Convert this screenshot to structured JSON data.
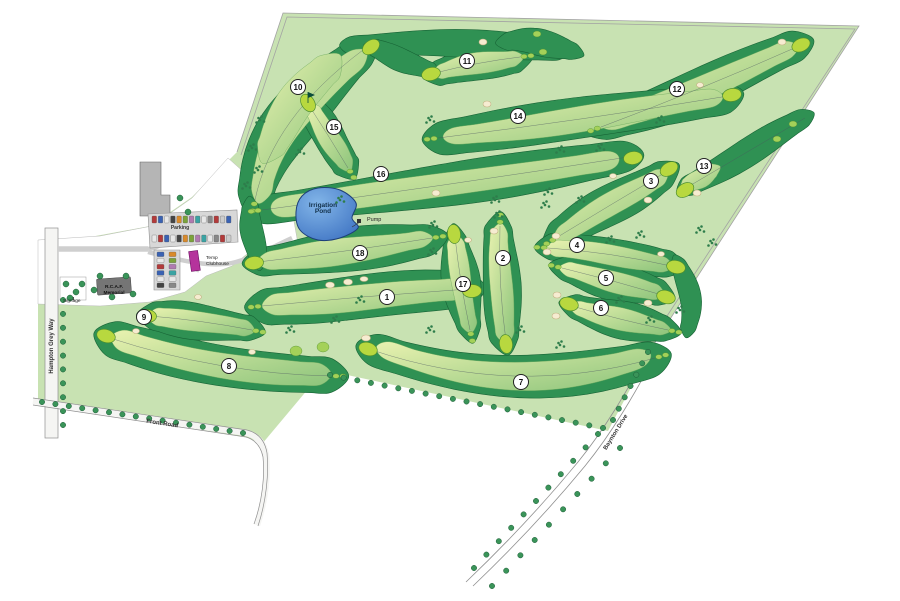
{
  "map": {
    "title": "Golf course site plan",
    "features": {
      "pond_label": "Irrigation Pond",
      "pump_label": "Pump",
      "parking_label": "Parking",
      "clubhouse_label": "Temp Clubhouse",
      "memorial_label": "R.C.A.F. Memorial",
      "signage_label": "Signage"
    },
    "roads": [
      "Hampton Grey Way",
      "Front Road",
      "Baynton Drive"
    ]
  },
  "labels": [
    {
      "id": "irrigation-pond",
      "lines": [
        "Irrigation",
        "Pond"
      ],
      "x": 323,
      "y": 207,
      "rotate": 0
    },
    {
      "id": "pump",
      "lines": [
        "Pump"
      ],
      "x": 367,
      "y": 221,
      "rotate": 0
    },
    {
      "id": "parking",
      "lines": [
        "Parking"
      ],
      "x": 180,
      "y": 229,
      "rotate": 0
    },
    {
      "id": "temp-clubhouse",
      "lines": [
        "Temp",
        "Clubhouse"
      ],
      "x": 206,
      "y": 259,
      "rotate": 0
    },
    {
      "id": "rcaf-memorial",
      "lines": [
        "R.C.A.F.",
        "Memorial"
      ],
      "x": 114,
      "y": 288,
      "rotate": 0
    },
    {
      "id": "signage",
      "lines": [
        "Signage"
      ],
      "x": 63,
      "y": 302,
      "rotate": 0
    },
    {
      "id": "hampton-grey-way",
      "lines": [
        "Hampton Grey Way"
      ],
      "x": 53,
      "y": 346,
      "rotate": -90
    },
    {
      "id": "front-road",
      "lines": [
        "Front Road"
      ],
      "x": 162,
      "y": 425,
      "rotate": 8.5
    },
    {
      "id": "baynton-drive",
      "lines": [
        "Baynton Drive"
      ],
      "x": 617,
      "y": 433,
      "rotate": -58
    }
  ],
  "holes": [
    {
      "number": "1",
      "x": 387,
      "y": 297
    },
    {
      "number": "2",
      "x": 503,
      "y": 258
    },
    {
      "number": "3",
      "x": 651,
      "y": 181
    },
    {
      "number": "4",
      "x": 577,
      "y": 245
    },
    {
      "number": "5",
      "x": 606,
      "y": 278
    },
    {
      "number": "6",
      "x": 601,
      "y": 308
    },
    {
      "number": "7",
      "x": 521,
      "y": 382
    },
    {
      "number": "8",
      "x": 229,
      "y": 366
    },
    {
      "number": "9",
      "x": 144,
      "y": 317
    },
    {
      "number": "10",
      "x": 298,
      "y": 87
    },
    {
      "number": "11",
      "x": 467,
      "y": 61
    },
    {
      "number": "12",
      "x": 677,
      "y": 89
    },
    {
      "number": "13",
      "x": 704,
      "y": 166
    },
    {
      "number": "14",
      "x": 518,
      "y": 116
    },
    {
      "number": "15",
      "x": 334,
      "y": 127
    },
    {
      "number": "16",
      "x": 381,
      "y": 174
    },
    {
      "number": "17",
      "x": 463,
      "y": 284
    },
    {
      "number": "18",
      "x": 360,
      "y": 253
    }
  ],
  "colors": {
    "land": "#c8e2b2",
    "rough": "#2f9153",
    "rough_edge": "#176335",
    "fairway_light": "#e9f2b0",
    "fairway_dark": "#8cc47b",
    "green": "#b8d83f",
    "green_edge": "#4f8f2f",
    "tee": "#a4d159",
    "bunker": "#f6ecd1",
    "bunker_edge": "#c4b283",
    "pond_light": "#82b5e8",
    "pond_dark": "#3a6fc0",
    "pond_edge": "#1d3f78",
    "tree": "#3a9459",
    "tree_edge": "#1c5c36",
    "shrub": "#2e7d4b",
    "road_fill": "#f5f5f3",
    "road_edge": "#8f8f8f",
    "asphalt": "#d8d8d8",
    "building": "#b5b5b5",
    "building_dark": "#757575",
    "clubhouse": "#b5339c",
    "boundary": "#a3a3a3",
    "centerline": "#4a5560"
  }
}
